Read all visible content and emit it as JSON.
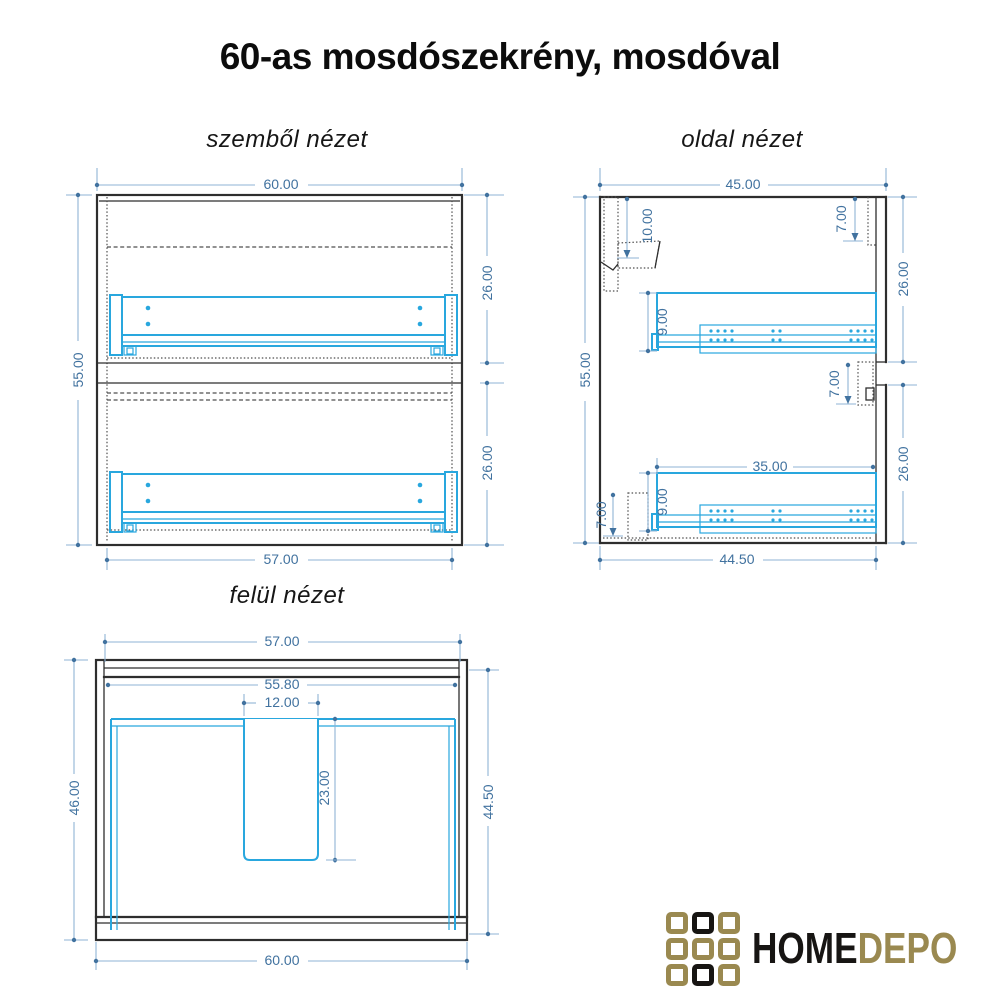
{
  "title": "60-as mosdószekrény, mosdóval",
  "views": {
    "front": {
      "label": "szemből nézet",
      "dims": {
        "overall_width": "60.00",
        "overall_height": "55.00",
        "top_drawer_height": "26.00",
        "bottom_drawer_height": "26.00",
        "inner_width": "57.00"
      }
    },
    "side": {
      "label": "oldal nézet",
      "dims": {
        "overall_depth": "45.00",
        "overall_height": "55.00",
        "top_front_height": "26.00",
        "bottom_front_height": "26.00",
        "carcass_depth": "44.50",
        "hanger_height": "10.00",
        "top_front_inset": "7.00",
        "top_rail_height": "9.00",
        "mid_front_inset": "7.00",
        "rail_length": "35.00",
        "bottom_rail_height": "9.00",
        "back_panel_inset": "7.00"
      }
    },
    "top": {
      "label": "felül nézet",
      "dims": {
        "cabinet_width": "57.00",
        "inner_width": "55.80",
        "cutout_width": "12.00",
        "cutout_depth": "23.00",
        "basin_depth": "46.00",
        "cabinet_depth": "44.50",
        "basin_width": "60.00"
      }
    }
  },
  "logo": {
    "text_primary": "HOME",
    "text_secondary": "DEPO"
  },
  "colors": {
    "drawing_black": "#2e2e2e",
    "hardware_cyan": "#29a7de",
    "dimension_blue": "#41729f",
    "dimension_line": "#8fb3d4",
    "logo_gold": "#9a8950",
    "logo_black": "#171513"
  }
}
